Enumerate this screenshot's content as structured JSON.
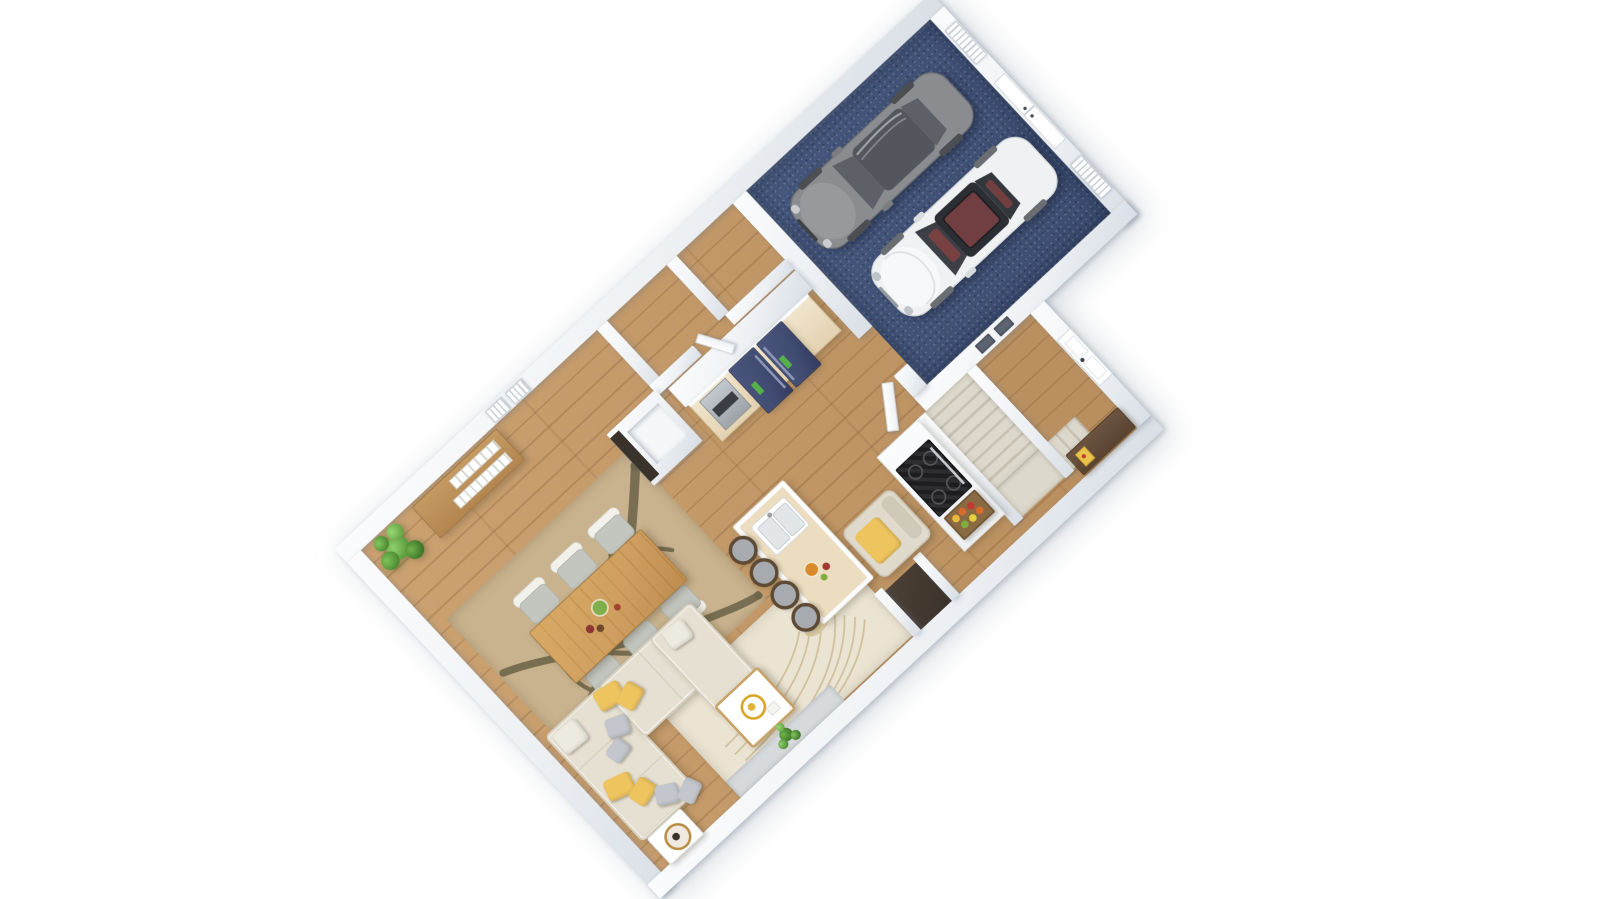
{
  "scene": {
    "type": "3d-floorplan-render",
    "view": "rotated top-down isometric",
    "floor": "first floor with attached two-car garage",
    "rotation_deg": -43,
    "background": "white"
  },
  "theme": {
    "bg": "#ffffff",
    "wall_light": "#fbfcfd",
    "wall_shadow": "#d9dfe6",
    "wood_light": "#cda271",
    "wood_dark": "#b88e5e",
    "carpet": "#3b4c70",
    "stair_tread": "#dcd8cb",
    "stair_dark": "#c6c1b2",
    "sofa": "#e6e0d2",
    "pillow_yellow": "#eec45f",
    "pillow_gray": "#c3c7cd",
    "rug_cream": "#ebe4d3",
    "rug_tan": "#c9b28e",
    "branch_olive": "#6d6549",
    "table_wood": "#cd9a58",
    "island_top": "#ecdcc0",
    "fridge_navy": "#414c72",
    "range_black": "#1d1d1f",
    "console_brown": "#5a4431",
    "car_gray": "#8a8c90",
    "car_white": "#eff1f3",
    "accent_green": "#66a845",
    "accent_red": "#b03a2e",
    "niche_floor": "#3b322a"
  },
  "rooms": [
    {
      "name": "garage",
      "floor": "navy-speckled-carpet",
      "items": [
        "gray-car",
        "white-car-with-red-interior",
        "double-entry-door",
        "louvered-window-upper",
        "louvered-window-lower"
      ]
    },
    {
      "name": "kitchen",
      "items": [
        "black-range",
        "navy-two-door-fridge-with-energy-labels",
        "wall-oven-cabinet",
        "upper-cabinet-wall",
        "island-with-double-sink",
        "four-stools",
        "fruit-crate",
        "pantry-closet",
        "ajar-door-to-garage"
      ]
    },
    {
      "name": "dining-area",
      "items": [
        "rectangular-wood-table",
        "six-chairs",
        "branch-pattern-rug",
        "wood-sideboard-with-books",
        "corner-potted-plant",
        "two-wall-windows",
        "table-centerpiece"
      ]
    },
    {
      "name": "living-area",
      "items": [
        "l-shaped-sectional-sofa",
        "yellow-and-gray-pillows",
        "white-gold-coffee-table",
        "white-side-table-with-round-tray",
        "beige-armchair-with-yellow-cushion",
        "bird-motif-cream-rug",
        "gray-floor-mat",
        "small-green-plant",
        "wall-niche-closet"
      ]
    },
    {
      "name": "entry-hall",
      "items": [
        "front-door",
        "long-walnut-console",
        "yellow-book",
        "two-wall-slots"
      ]
    },
    {
      "name": "staircase",
      "items": [
        "straight-run-treads",
        "landing",
        "lower-return-steps",
        "white-stringer-walls"
      ]
    },
    {
      "name": "mudroom-closets",
      "items": [
        "two-small-wood-floor-rooms",
        "ajar-closet-door"
      ]
    }
  ],
  "counts": {
    "cars": 2,
    "dining_chairs": 6,
    "island_stools": 4,
    "stair_treads": 9,
    "lower_steps": 3,
    "garage_wall_windows": 2,
    "top_wall_windows": 2,
    "sofa_pillows": 10
  },
  "vehicles": [
    {
      "id": "car-gray",
      "body": "dark-gray",
      "detail": "panoramic glass roof"
    },
    {
      "id": "car-white",
      "body": "white",
      "detail": "dark sunroof showing red seats"
    }
  ]
}
